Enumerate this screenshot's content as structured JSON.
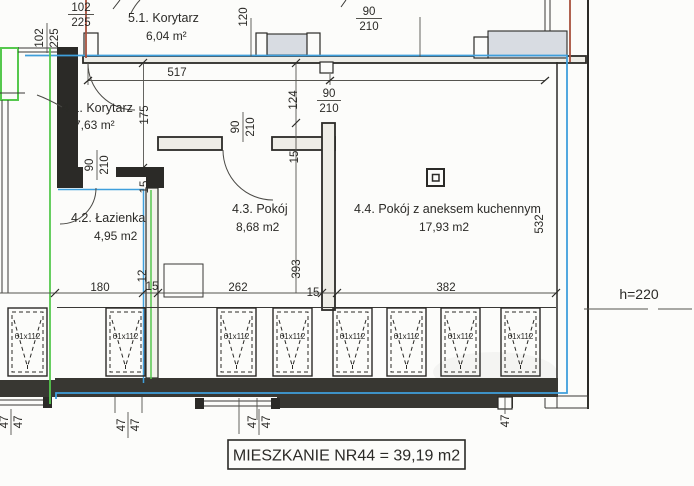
{
  "rooms": {
    "r51": {
      "name": "5.1. Korytarz",
      "area": "6,04 m²"
    },
    "r41": {
      "name": "4.1. Korytarz",
      "area": "7,63 m²"
    },
    "r42": {
      "name": "4.2. Łazienka",
      "area": "4,95 m2"
    },
    "r43": {
      "name": "4.3. Pokój",
      "area": "8,68 m2"
    },
    "r44": {
      "name": "4.4. Pokój z aneksem kuchennym",
      "area": "17,93 m2"
    }
  },
  "apartment_summary": "MIESZKANIE NR44 = 39,19 m2",
  "openings": {
    "o102": {
      "num": "102",
      "den": "225"
    },
    "o90": {
      "num": "90",
      "den": "210"
    }
  },
  "dims": {
    "d517": "517",
    "d120": "120",
    "d124": "124",
    "d175": "175",
    "d393": "393",
    "d532": "532",
    "d180": "180",
    "d262": "262",
    "d382": "382",
    "d15": "15",
    "d12": "12",
    "d47": "47",
    "height_note": "h=220"
  },
  "radiator_label": "61x112",
  "colors": {
    "blue_line": "#3f9fdc",
    "green_line": "#56c84e",
    "red_line": "#a8503e",
    "wall_ink": "#2b2a27"
  }
}
